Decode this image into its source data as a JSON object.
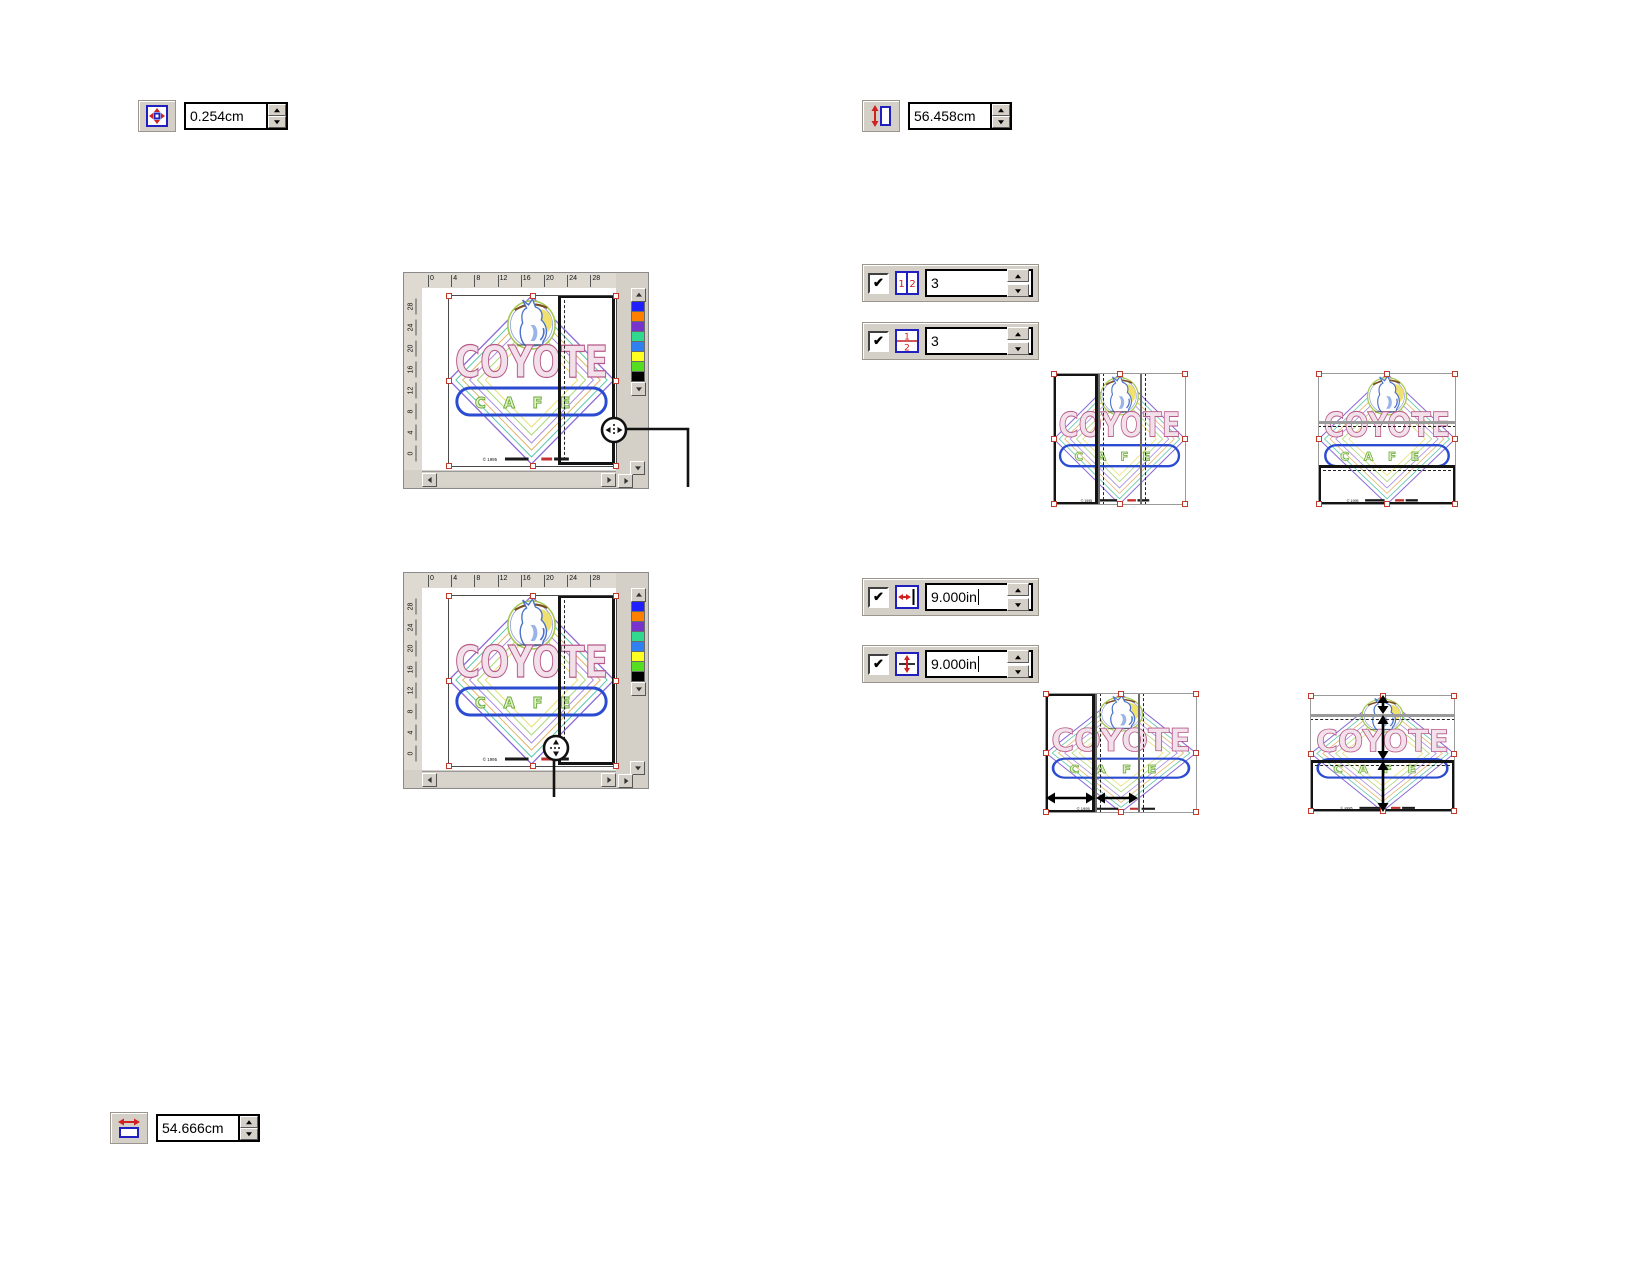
{
  "controls": {
    "nudge_offset": {
      "value": "0.254cm",
      "icon": "nudge-icon"
    },
    "object_height": {
      "value": "56.458cm",
      "icon": "object-height-icon"
    },
    "object_width": {
      "value": "54.666cm",
      "icon": "object-width-icon"
    },
    "columns": {
      "checked": true,
      "value": "3",
      "icon": "columns-icon"
    },
    "rows": {
      "checked": true,
      "value": "3",
      "icon": "rows-icon"
    },
    "column_width": {
      "checked": true,
      "value": "9.000in",
      "icon": "column-width-icon"
    },
    "row_height": {
      "checked": true,
      "value": "9.000in",
      "icon": "row-height-icon"
    }
  },
  "checkbox_glyph": "✔",
  "canvas_window": {
    "h_ruler_ticks": [
      "0",
      "4",
      "8",
      "12",
      "16",
      "20",
      "24",
      "28"
    ],
    "v_ruler_ticks": [
      "28",
      "24",
      "20",
      "16",
      "12",
      "8",
      "4",
      "0"
    ],
    "palette_colors": [
      "#2020ff",
      "#ff8000",
      "#7733cc",
      "#30d890",
      "#3080f0",
      "#ffff20",
      "#55dd22",
      "#000000"
    ]
  },
  "logo": {
    "title": "COYOTE",
    "subtitle": "CAFE",
    "copyright": "© 1995"
  }
}
